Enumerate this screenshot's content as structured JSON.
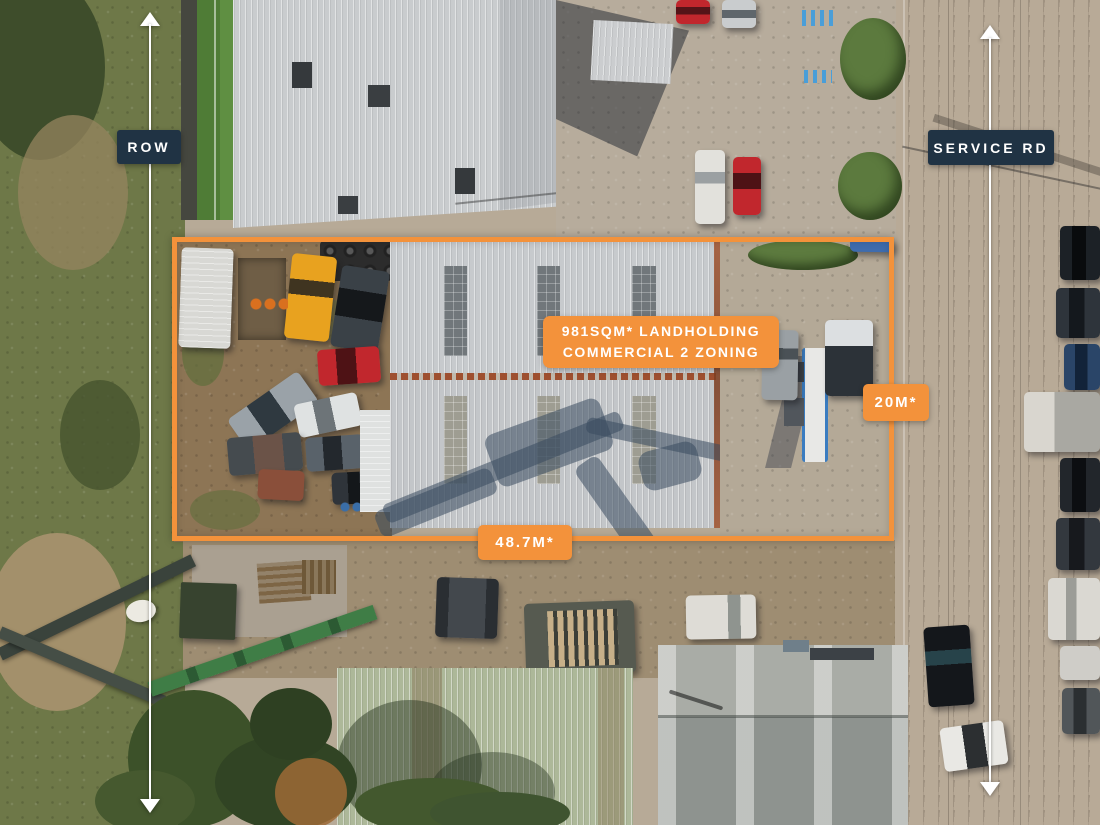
{
  "overlay": {
    "row_label": "ROW",
    "service_rd_label": "SERVICE RD",
    "landholding_line1": "981SQM* LANDHOLDING",
    "landholding_line2": "COMMERCIAL 2 ZONING",
    "depth_dimension": "20M*",
    "frontage_dimension": "48.7M*",
    "icons": {
      "left_dimension": "double-arrow-vertical",
      "right_dimension": "double-arrow-vertical"
    },
    "colors": {
      "accent_orange": "#F3923B",
      "label_navy": "#203344",
      "arrow_white": "#FFFFFF"
    }
  }
}
